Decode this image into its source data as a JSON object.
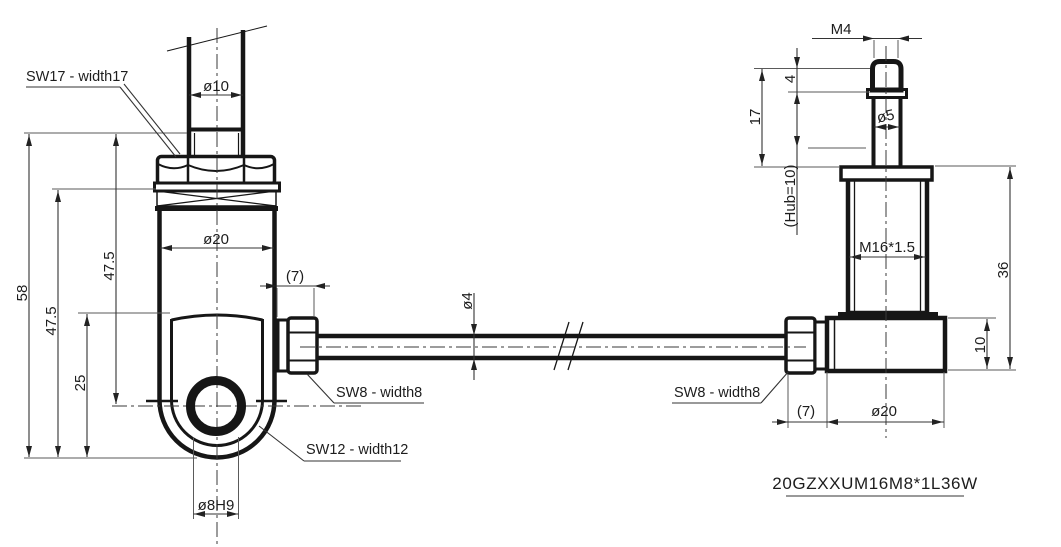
{
  "background": "#ffffff",
  "ink_color": "#161616",
  "part_number": "20GZXXUM16M8*1L36W",
  "left_view": {
    "labels": {
      "wrench_flats_17": "SW17 - width17",
      "wrench_flats_8": "SW8 - width8",
      "wrench_flats_12": "SW12 - width12"
    },
    "dims": {
      "rod_diameter": "ø10",
      "overall_length": "58",
      "shank_length": "47.5",
      "hole_center_offset": "25",
      "rod_to_hole_center": "47.5",
      "body_diameter": "ø20",
      "hex_length": "(7)",
      "hole_bore": "ø8H9"
    }
  },
  "cable": {
    "dims": {
      "wire_diameter": "ø4"
    }
  },
  "right_view": {
    "labels": {
      "wrench_flats_8": "SW8 - width8"
    },
    "dims": {
      "tip_thread": "M4",
      "tip_length": "4",
      "pin_extension": "17",
      "pin_diameter": "ø5",
      "stroke": "(Hub=10)",
      "housing_thread": "M16*1.5",
      "housing_length": "36",
      "block_height": "10",
      "hex_length": "(7)",
      "block_diameter": "ø20"
    }
  }
}
